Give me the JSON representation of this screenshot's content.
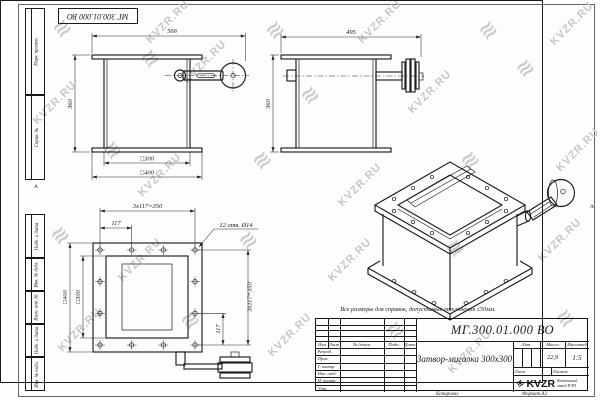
{
  "stamp": {
    "doc_number": "МГ 300.01.000 ВО"
  },
  "margin": {
    "fields": [
      "Перв. примен.",
      "Справ. №",
      "Подп. и дата",
      "Инв. № дубл.",
      "Взам. инв. №",
      "Подп. и дата",
      "Инв. № подл."
    ]
  },
  "marks": {
    "fold": "А"
  },
  "note": {
    "text": "Все размеры для справок, допустимые отклонения ±50мм."
  },
  "dims": {
    "front_width": "566",
    "front_height": "360",
    "front_inner": "□300",
    "front_outer": "□400",
    "side_width": "495",
    "side_height": "360",
    "plan_pitch3": "3x117=350",
    "plan_pitch": "117",
    "plan_holes": "12 отв. Ø14",
    "plan_outer": "□400",
    "plan_inner": "□300",
    "plan_pitch3_r": "3x117=350",
    "plan_pitch_r": "117"
  },
  "tb": {
    "doc_number": "МГ.300.01.000 ВО",
    "name": "Затвор-мигалка 300х300",
    "cols": [
      "Изм",
      "Лист",
      "№ докум.",
      "Подп.",
      "Дата"
    ],
    "rows": [
      "Разраб.",
      "Пров.",
      "Т. контр.",
      "Нач. отд.",
      "Н. контр.",
      "Утв."
    ],
    "lit_label": "Лит.",
    "mass_label": "Масса",
    "scale_label": "Масштаб",
    "mass_value": "22,9",
    "scale_value": "1:5",
    "sheet_label": "Лист",
    "sheets_label": "Листов",
    "logo_text": "KVZR",
    "company": "Котельный завод РЭП"
  },
  "footer": {
    "copy": "Копировал",
    "format": "Формат А3"
  },
  "watermark": {
    "text": "KVZR.RU",
    "glyph": "≋",
    "color": "#c7c7c7",
    "positions": [
      {
        "x": 62,
        "y": 28,
        "type": "glyph"
      },
      {
        "x": 168,
        "y": 22,
        "type": "text"
      },
      {
        "x": 275,
        "y": 30,
        "type": "glyph"
      },
      {
        "x": 380,
        "y": 22,
        "type": "text"
      },
      {
        "x": 488,
        "y": 30,
        "type": "glyph"
      },
      {
        "x": 572,
        "y": 24,
        "type": "text"
      },
      {
        "x": 55,
        "y": 103,
        "type": "text"
      },
      {
        "x": 150,
        "y": 58,
        "type": "glyph"
      },
      {
        "x": 205,
        "y": 62,
        "type": "text"
      },
      {
        "x": 310,
        "y": 95,
        "type": "glyph"
      },
      {
        "x": 430,
        "y": 92,
        "type": "text"
      },
      {
        "x": 525,
        "y": 68,
        "type": "glyph"
      },
      {
        "x": 112,
        "y": 150,
        "type": "glyph"
      },
      {
        "x": 160,
        "y": 175,
        "type": "text"
      },
      {
        "x": 262,
        "y": 160,
        "type": "glyph"
      },
      {
        "x": 360,
        "y": 185,
        "type": "text"
      },
      {
        "x": 470,
        "y": 160,
        "type": "glyph"
      },
      {
        "x": 578,
        "y": 150,
        "type": "text"
      },
      {
        "x": 60,
        "y": 235,
        "type": "glyph"
      },
      {
        "x": 140,
        "y": 260,
        "type": "text"
      },
      {
        "x": 248,
        "y": 240,
        "type": "glyph"
      },
      {
        "x": 350,
        "y": 260,
        "type": "text"
      },
      {
        "x": 455,
        "y": 248,
        "type": "glyph"
      },
      {
        "x": 560,
        "y": 240,
        "type": "text"
      },
      {
        "x": 80,
        "y": 330,
        "type": "text"
      },
      {
        "x": 190,
        "y": 320,
        "type": "glyph"
      },
      {
        "x": 290,
        "y": 335,
        "type": "text"
      },
      {
        "x": 395,
        "y": 330,
        "type": "glyph"
      },
      {
        "x": 470,
        "y": 352,
        "type": "text"
      },
      {
        "x": 565,
        "y": 318,
        "type": "glyph"
      }
    ]
  }
}
